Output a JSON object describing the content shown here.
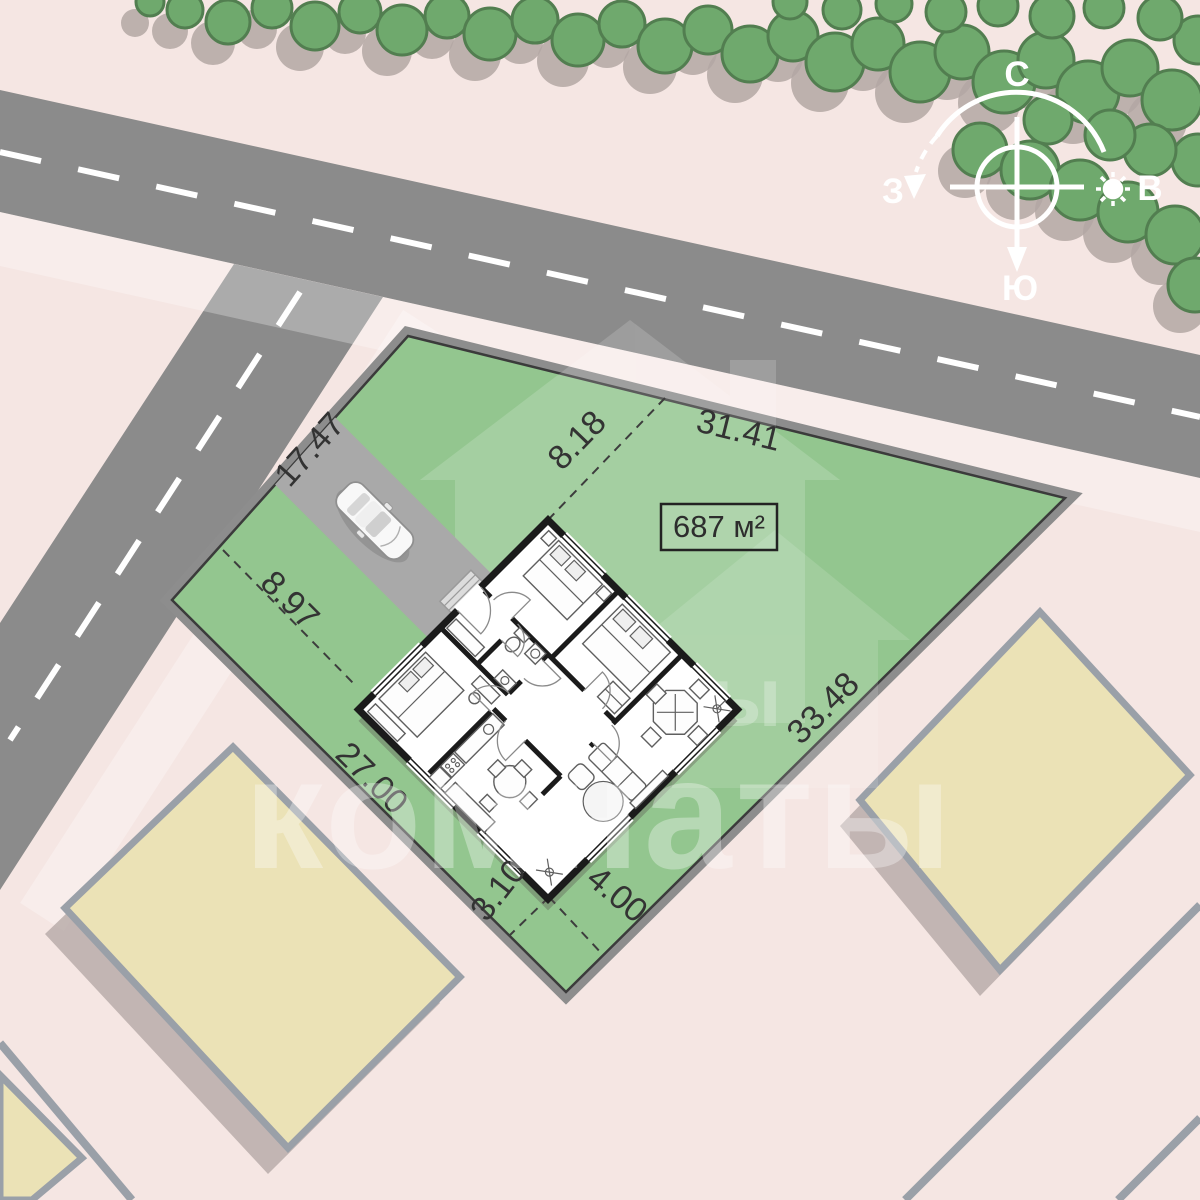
{
  "site": {
    "area_label": "687 м²",
    "dimensions": {
      "nw_edge": "17.47",
      "ne_edge": "31.41",
      "se_edge": "33.48",
      "sw_edge": "27.00",
      "house_offset_west": "8.97",
      "house_offset_north": "8.18",
      "house_offset_south_west": "3.10",
      "house_offset_south_east": "4.00"
    },
    "compass": {
      "north": "С",
      "east": "В",
      "south": "Ю",
      "west": "З"
    },
    "watermark_text": "комнаты"
  },
  "colors": {
    "background_pink": "#f5e6e3",
    "road_gray": "#8b8b8b",
    "lane_marking": "#ffffff",
    "tree_green": "#6fa96d",
    "tree_outline": "#527e50",
    "tree_shadow": "#b3a7a3",
    "plot_green": "#93c68f",
    "plot_border": "#3b3b3b",
    "driveway_gray": "#a9a9a9",
    "building_yellow": "#ebe2b6",
    "building_outline": "#9aa0a8",
    "building_shadow": "#b5a9a6",
    "wall_black": "#1b1b1b",
    "dimension_text": "#333333"
  }
}
